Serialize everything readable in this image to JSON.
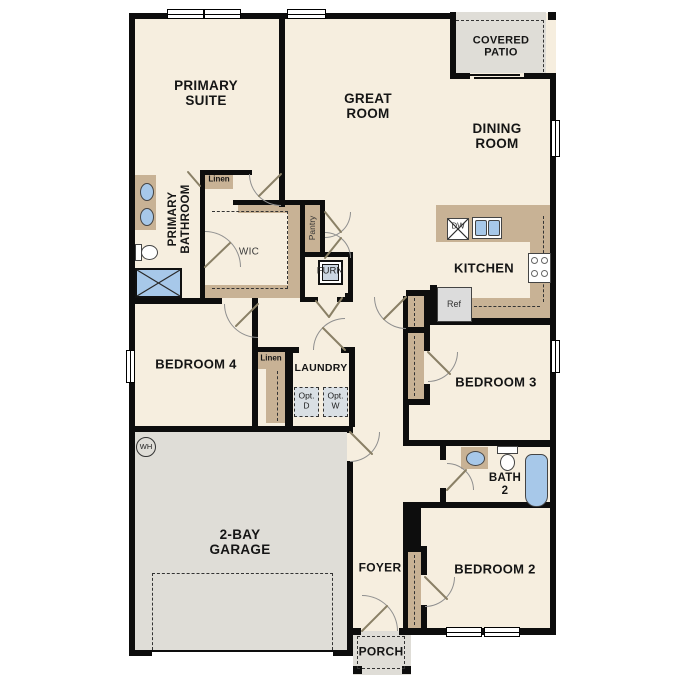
{
  "plan_title": "single-story house floor plan",
  "colors": {
    "floor": "#F6EEDF",
    "wall": "#0D0D0D",
    "cabinet_tan": "#C8B295",
    "exterior_gray": "#DFDDD7",
    "fixture_blue": "#A7C8E9",
    "option_fill": "#D9DFE4"
  },
  "rooms": {
    "primary_suite": "PRIMARY\nSUITE",
    "great_room": "GREAT\nROOM",
    "dining_room": "DINING\nROOM",
    "covered_patio": "COVERED\nPATIO",
    "kitchen": "KITCHEN",
    "primary_bathroom": "PRIMARY\nBATHROOM",
    "wic": "WIC",
    "bedroom4": "BEDROOM 4",
    "laundry": "LAUNDRY",
    "bedroom3": "BEDROOM 3",
    "bath2": "BATH\n2",
    "bedroom2": "BEDROOM 2",
    "garage": "2-BAY\nGARAGE",
    "foyer": "FOYER",
    "porch": "PORCH"
  },
  "fixtures": {
    "linen1": "Linen",
    "linen2": "Linen",
    "pantry": "Pantry",
    "furnace": "FURN",
    "dishwasher": "DW",
    "refrigerator": "Ref",
    "opt_dryer": "Opt.\nD",
    "opt_washer": "Opt.\nW",
    "water_heater": "WH"
  }
}
